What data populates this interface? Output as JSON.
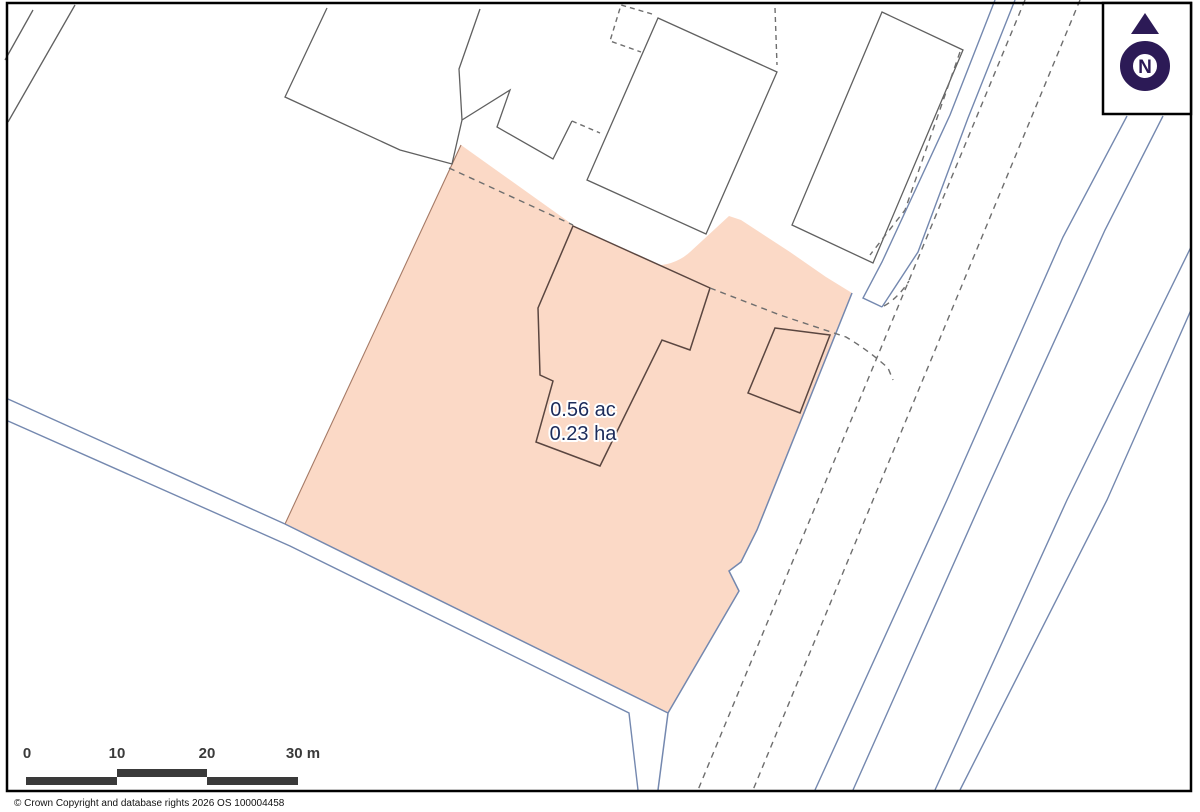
{
  "map": {
    "parcel": {
      "area_acres": "0.56 ac",
      "area_hectares": "0.23 ha"
    },
    "north_indicator": {
      "letter": "N"
    },
    "scale_bar": {
      "ticks": [
        "0",
        "10",
        "20",
        "30 m"
      ]
    },
    "attribution": "© Crown Copyright and database rights 2026 OS 100004458",
    "colors": {
      "parcel_fill": "#fbd9c6",
      "parcel_edge_brown": "#a57a66",
      "road_blue": "#7488af",
      "boundary_gray": "#606060",
      "dashed_gray": "#6e6e6e",
      "building_outline": "#5a4640",
      "north_purple": "#2c1a56",
      "scalebar_gray": "#3a3a3a",
      "label_navy": "#1c2b5a",
      "frame_black": "#000000"
    }
  }
}
